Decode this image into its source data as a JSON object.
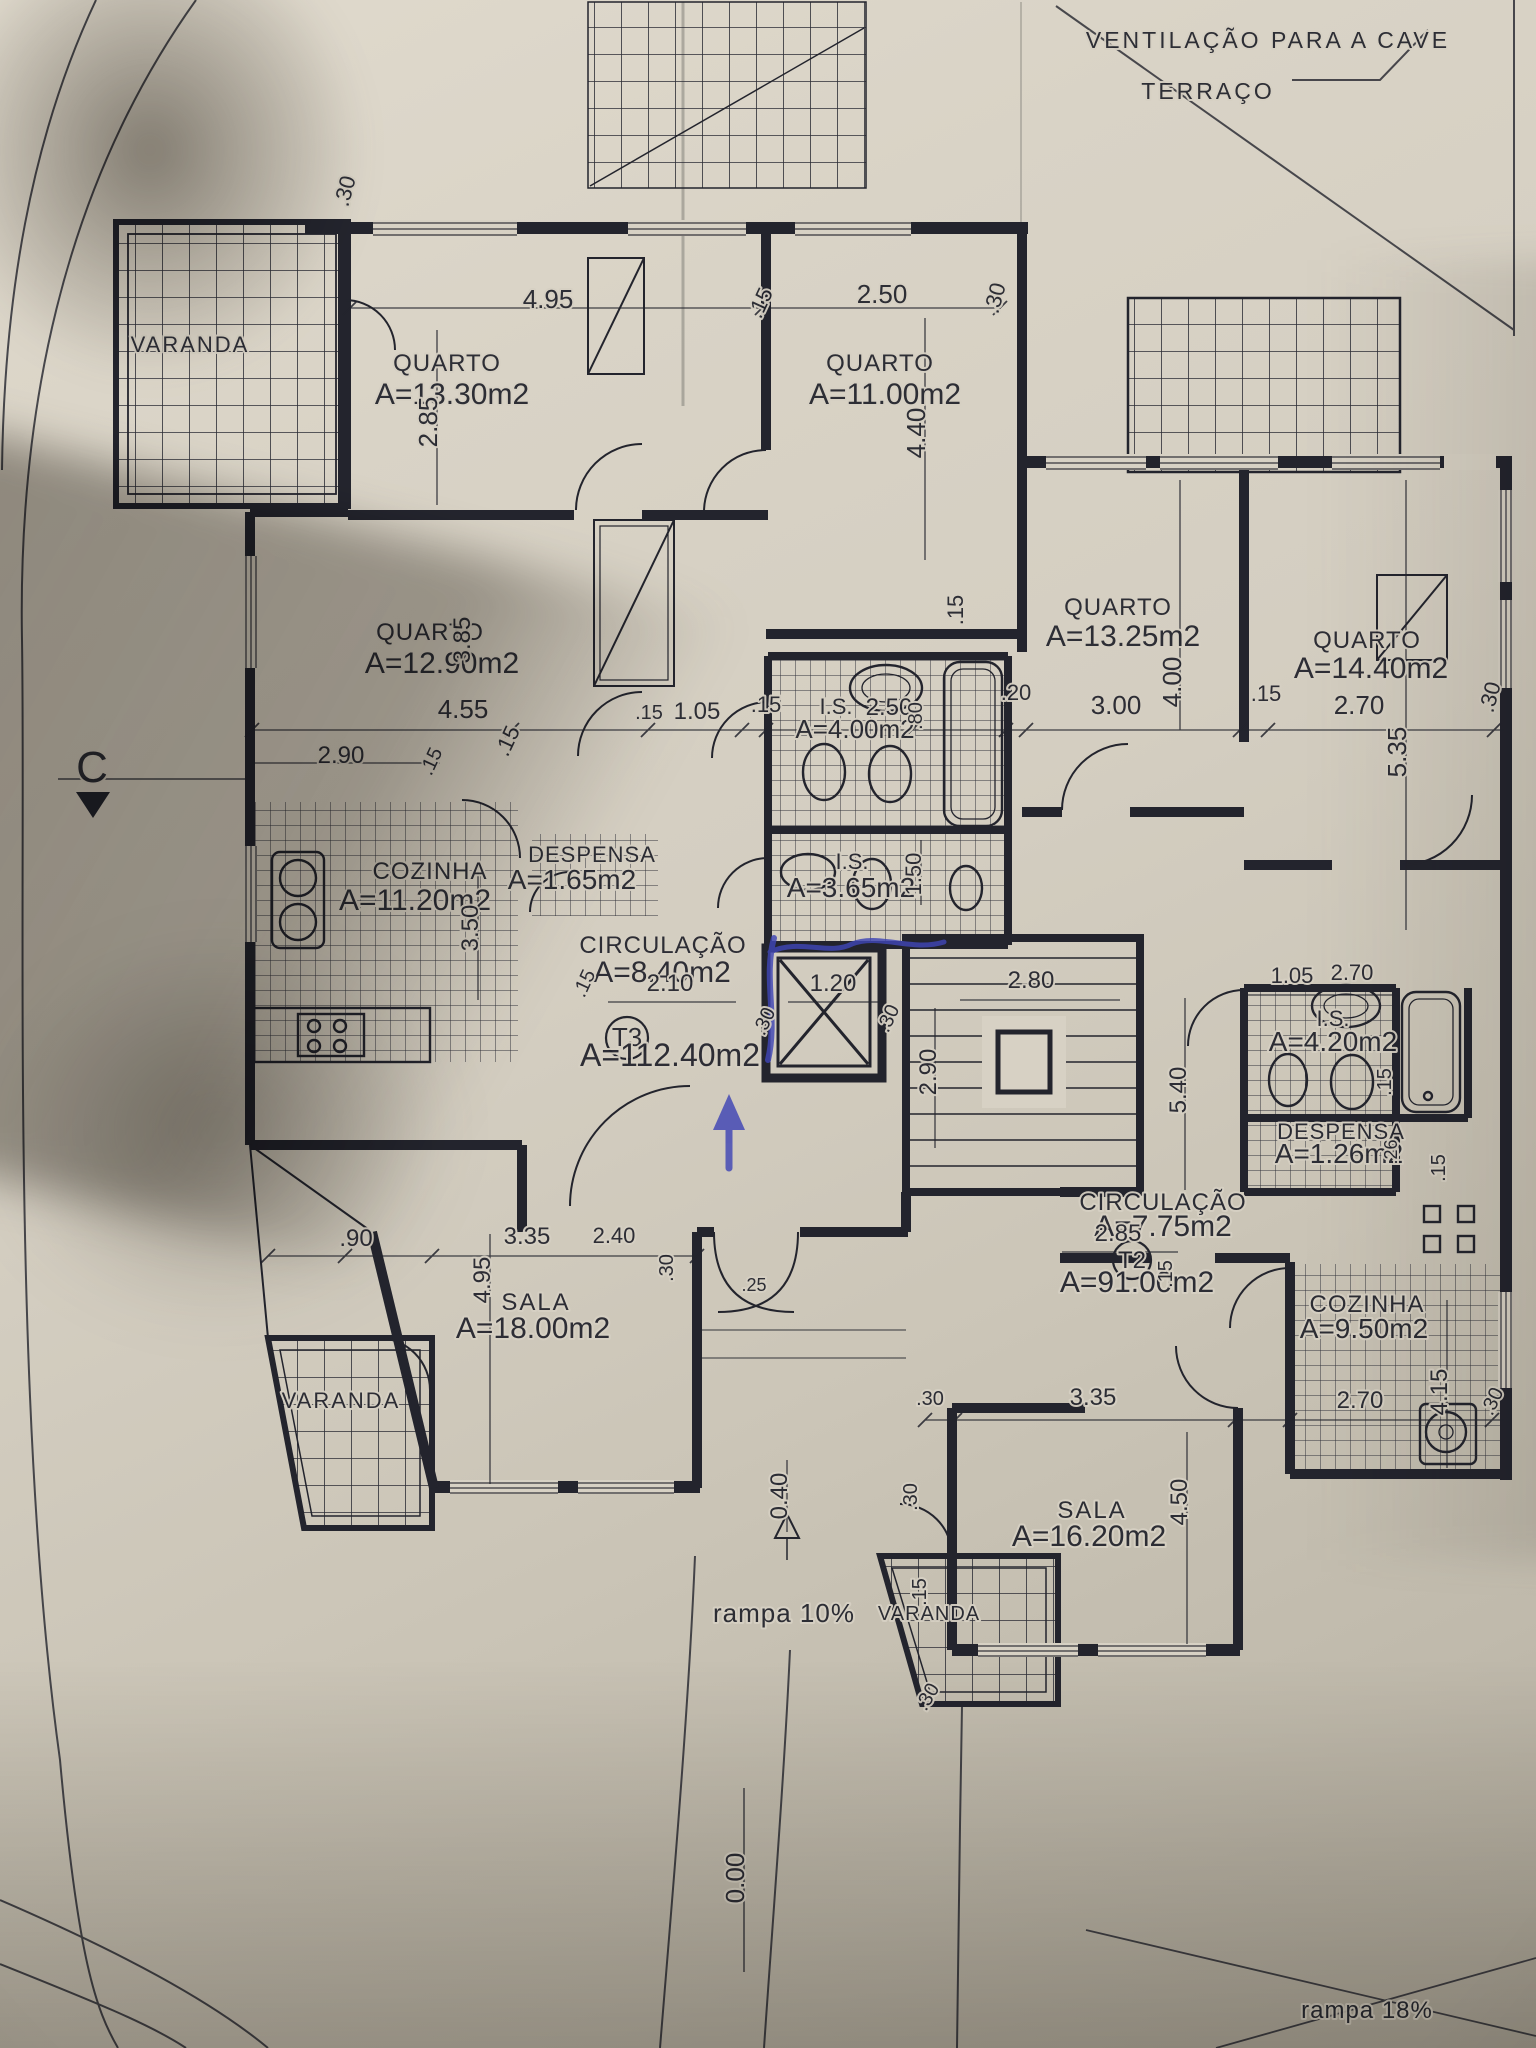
{
  "colors": {
    "paper": "#d7d1c4",
    "ink": "#23242d",
    "pen_blue": "#3f45b5"
  },
  "plan": {
    "type": "architectural-floor-plan",
    "apartments": [
      {
        "code": "T3",
        "total_area": "A=112.40m2"
      },
      {
        "code": "T2",
        "total_area": "A=91.00m2"
      }
    ]
  },
  "labels": {
    "t3": [
      {
        "t": "VARANDA",
        "x": 190,
        "y": 352,
        "s": 22,
        "ls": 2
      },
      {
        "t": "QUARTO",
        "x": 447,
        "y": 371,
        "s": 24,
        "ls": 1
      },
      {
        "t": "A=13.30m2",
        "x": 452,
        "y": 404,
        "s": 30
      },
      {
        "t": "QUARTO",
        "x": 880,
        "y": 371,
        "s": 24,
        "ls": 1
      },
      {
        "t": "A=11.00m2",
        "x": 885,
        "y": 404,
        "s": 30
      },
      {
        "t": "QUARTO",
        "x": 430,
        "y": 640,
        "s": 24,
        "ls": 1
      },
      {
        "t": "A=12.90m2",
        "x": 442,
        "y": 673,
        "s": 30
      },
      {
        "t": "COZINHA",
        "x": 430,
        "y": 879,
        "s": 24,
        "ls": 1
      },
      {
        "t": "A=11.20m2",
        "x": 415,
        "y": 910,
        "s": 30
      },
      {
        "t": "DESPENSA",
        "x": 592,
        "y": 862,
        "s": 22,
        "ls": 1
      },
      {
        "t": "A=1.65m2",
        "x": 572,
        "y": 889,
        "s": 28
      },
      {
        "t": "CIRCULAÇÃO",
        "x": 663,
        "y": 953,
        "s": 24,
        "ls": 1
      },
      {
        "t": "A=8.40m2",
        "x": 662,
        "y": 982,
        "s": 30
      },
      {
        "t": "I.S.",
        "x": 836,
        "y": 714,
        "s": 22
      },
      {
        "t": "A=4.00m2",
        "x": 855,
        "y": 738,
        "s": 26
      },
      {
        "t": "I.S.",
        "x": 852,
        "y": 869,
        "s": 22
      },
      {
        "t": "A=3.65m2",
        "x": 851,
        "y": 897,
        "s": 28
      },
      {
        "t": "T3",
        "x": 627,
        "y": 1046,
        "s": 26
      },
      {
        "t": "A=112.40m2",
        "x": 670,
        "y": 1066,
        "s": 32
      },
      {
        "t": "SALA",
        "x": 536,
        "y": 1310,
        "s": 24,
        "ls": 2
      },
      {
        "t": "A=18.00m2",
        "x": 533,
        "y": 1338,
        "s": 30
      },
      {
        "t": "VARANDA",
        "x": 341,
        "y": 1408,
        "s": 22,
        "ls": 2
      }
    ],
    "t2": [
      {
        "t": "QUARTO",
        "x": 1118,
        "y": 615,
        "s": 24,
        "ls": 1
      },
      {
        "t": "A=13.25m2",
        "x": 1123,
        "y": 646,
        "s": 30
      },
      {
        "t": "QUARTO",
        "x": 1367,
        "y": 648,
        "s": 24,
        "ls": 1
      },
      {
        "t": "A=14.40m2",
        "x": 1371,
        "y": 678,
        "s": 30
      },
      {
        "t": "I.S.",
        "x": 1333,
        "y": 1026,
        "s": 22
      },
      {
        "t": "A=4.20m2",
        "x": 1333,
        "y": 1051,
        "s": 28
      },
      {
        "t": "DESPENSA",
        "x": 1341,
        "y": 1139,
        "s": 22,
        "ls": 1
      },
      {
        "t": "A=1.26m2",
        "x": 1339,
        "y": 1163,
        "s": 28
      },
      {
        "t": "CIRCULAÇÃO",
        "x": 1163,
        "y": 1210,
        "s": 24,
        "ls": 1
      },
      {
        "t": "A=7.75m2",
        "x": 1163,
        "y": 1236,
        "s": 30
      },
      {
        "t": "T2",
        "x": 1132,
        "y": 1268,
        "s": 24
      },
      {
        "t": "A=91.00m2",
        "x": 1137,
        "y": 1292,
        "s": 30
      },
      {
        "t": "COZINHA",
        "x": 1367,
        "y": 1312,
        "s": 24,
        "ls": 1
      },
      {
        "t": "A=9.50m2",
        "x": 1364,
        "y": 1338,
        "s": 28
      },
      {
        "t": "SALA",
        "x": 1092,
        "y": 1518,
        "s": 24,
        "ls": 2
      },
      {
        "t": "A=16.20m2",
        "x": 1089,
        "y": 1546,
        "s": 30
      },
      {
        "t": "VARANDA",
        "x": 929,
        "y": 1620,
        "s": 20,
        "ls": 1
      }
    ],
    "common": [
      {
        "t": "VENTILAÇÃO PARA A CAVE",
        "x": 1268,
        "y": 48,
        "s": 23,
        "ls": 3
      },
      {
        "t": "TERRAÇO",
        "x": 1208,
        "y": 99,
        "s": 23,
        "ls": 3
      },
      {
        "t": "rampa 10%",
        "x": 784,
        "y": 1622,
        "s": 26,
        "ls": 1
      },
      {
        "t": "rampa 18%",
        "x": 1367,
        "y": 2018,
        "s": 24,
        "ls": 1
      },
      {
        "t": "C",
        "x": 92,
        "y": 782,
        "s": 44
      },
      {
        "t": "0.40",
        "x": 787,
        "y": 1496,
        "s": 24,
        "r": -90
      },
      {
        "t": "0.00",
        "x": 744,
        "y": 1878,
        "s": 26,
        "r": -90
      }
    ],
    "dims": [
      {
        "t": ".30",
        "x": 352,
        "y": 193,
        "s": 22,
        "r": -75
      },
      {
        "t": "4.95",
        "x": 548,
        "y": 308,
        "s": 26
      },
      {
        "t": "2.85",
        "x": 437,
        "y": 422,
        "s": 26,
        "r": -90
      },
      {
        "t": ".15",
        "x": 767,
        "y": 306,
        "s": 22,
        "r": -65
      },
      {
        "t": "2.50",
        "x": 882,
        "y": 303,
        "s": 26
      },
      {
        "t": ".30",
        "x": 1002,
        "y": 300,
        "s": 22,
        "r": -75
      },
      {
        "t": "4.40",
        "x": 925,
        "y": 433,
        "s": 26,
        "r": -90
      },
      {
        "t": "3.85",
        "x": 470,
        "y": 640,
        "s": 24,
        "r": -90
      },
      {
        "t": "4.55",
        "x": 463,
        "y": 718,
        "s": 26
      },
      {
        "t": ".15",
        "x": 514,
        "y": 744,
        "s": 22,
        "r": -65
      },
      {
        "t": ".15",
        "x": 649,
        "y": 719,
        "s": 20
      },
      {
        "t": "1.05",
        "x": 697,
        "y": 719,
        "s": 24
      },
      {
        "t": ".15",
        "x": 766,
        "y": 712,
        "s": 22
      },
      {
        "t": "2.50",
        "x": 889,
        "y": 715,
        "s": 24
      },
      {
        "t": ".80",
        "x": 922,
        "y": 716,
        "s": 20,
        "r": -90
      },
      {
        "t": ".20",
        "x": 1016,
        "y": 700,
        "s": 22
      },
      {
        "t": "3.00",
        "x": 1116,
        "y": 714,
        "s": 26
      },
      {
        "t": "4.00",
        "x": 1181,
        "y": 682,
        "s": 26,
        "r": -90
      },
      {
        "t": ".15",
        "x": 1266,
        "y": 701,
        "s": 22
      },
      {
        "t": "2.70",
        "x": 1359,
        "y": 714,
        "s": 26
      },
      {
        "t": "5.35",
        "x": 1406,
        "y": 752,
        "s": 26,
        "r": -90
      },
      {
        "t": ".30",
        "x": 1497,
        "y": 699,
        "s": 22,
        "r": -75
      },
      {
        "t": ".15",
        "x": 963,
        "y": 610,
        "s": 22,
        "r": -90
      },
      {
        "t": "2.90",
        "x": 341,
        "y": 763,
        "s": 24
      },
      {
        "t": ".15",
        "x": 437,
        "y": 764,
        "s": 20,
        "r": -65
      },
      {
        "t": "3.50",
        "x": 478,
        "y": 928,
        "s": 24,
        "r": -90
      },
      {
        "t": ".15",
        "x": 590,
        "y": 986,
        "s": 20,
        "r": -65
      },
      {
        "t": "2.10",
        "x": 670,
        "y": 991,
        "s": 24
      },
      {
        "t": "1.20",
        "x": 833,
        "y": 991,
        "s": 24
      },
      {
        "t": ".30",
        "x": 770,
        "y": 1024,
        "s": 20,
        "r": -65
      },
      {
        "t": ".30",
        "x": 894,
        "y": 1021,
        "s": 20,
        "r": -65
      },
      {
        "t": "2.80",
        "x": 1031,
        "y": 988,
        "s": 24
      },
      {
        "t": "2.90",
        "x": 936,
        "y": 1072,
        "s": 24,
        "r": -90
      },
      {
        "t": "5.40",
        "x": 1186,
        "y": 1090,
        "s": 24,
        "r": -90
      },
      {
        "t": "1.05",
        "x": 1292,
        "y": 983,
        "s": 22
      },
      {
        "t": "2.70",
        "x": 1352,
        "y": 980,
        "s": 22
      },
      {
        "t": "1.50",
        "x": 921,
        "y": 874,
        "s": 22,
        "r": -90
      },
      {
        "t": ".15",
        "x": 1391,
        "y": 1082,
        "s": 20,
        "r": -90
      },
      {
        "t": ".26",
        "x": 1397,
        "y": 1152,
        "s": 18,
        "r": -90
      },
      {
        "t": ".15",
        "x": 1445,
        "y": 1168,
        "s": 20,
        "r": -90
      },
      {
        "t": ".15",
        "x": 1172,
        "y": 1274,
        "s": 20,
        "r": -90
      },
      {
        "t": "2.85",
        "x": 1118,
        "y": 1241,
        "s": 24
      },
      {
        "t": ".90",
        "x": 356,
        "y": 1246,
        "s": 24
      },
      {
        "t": "3.35",
        "x": 527,
        "y": 1244,
        "s": 24
      },
      {
        "t": "2.40",
        "x": 614,
        "y": 1243,
        "s": 22
      },
      {
        "t": ".30",
        "x": 673,
        "y": 1268,
        "s": 20,
        "r": -90
      },
      {
        "t": ".25",
        "x": 754,
        "y": 1291,
        "s": 18
      },
      {
        "t": "4.95",
        "x": 490,
        "y": 1280,
        "s": 24,
        "r": -90
      },
      {
        "t": ".30",
        "x": 930,
        "y": 1405,
        "s": 20
      },
      {
        "t": "3.35",
        "x": 1093,
        "y": 1405,
        "s": 24
      },
      {
        "t": "2.70",
        "x": 1360,
        "y": 1408,
        "s": 24
      },
      {
        "t": ".30",
        "x": 1498,
        "y": 1404,
        "s": 20,
        "r": -65
      },
      {
        "t": "4.15",
        "x": 1447,
        "y": 1392,
        "s": 24,
        "r": -90
      },
      {
        "t": "4.50",
        "x": 1187,
        "y": 1502,
        "s": 24,
        "r": -90
      },
      {
        "t": ".30",
        "x": 917,
        "y": 1497,
        "s": 20,
        "r": -90
      },
      {
        "t": ".15",
        "x": 926,
        "y": 1592,
        "s": 20,
        "r": -90
      },
      {
        "t": ".30",
        "x": 933,
        "y": 1700,
        "s": 20,
        "r": -60
      }
    ]
  }
}
